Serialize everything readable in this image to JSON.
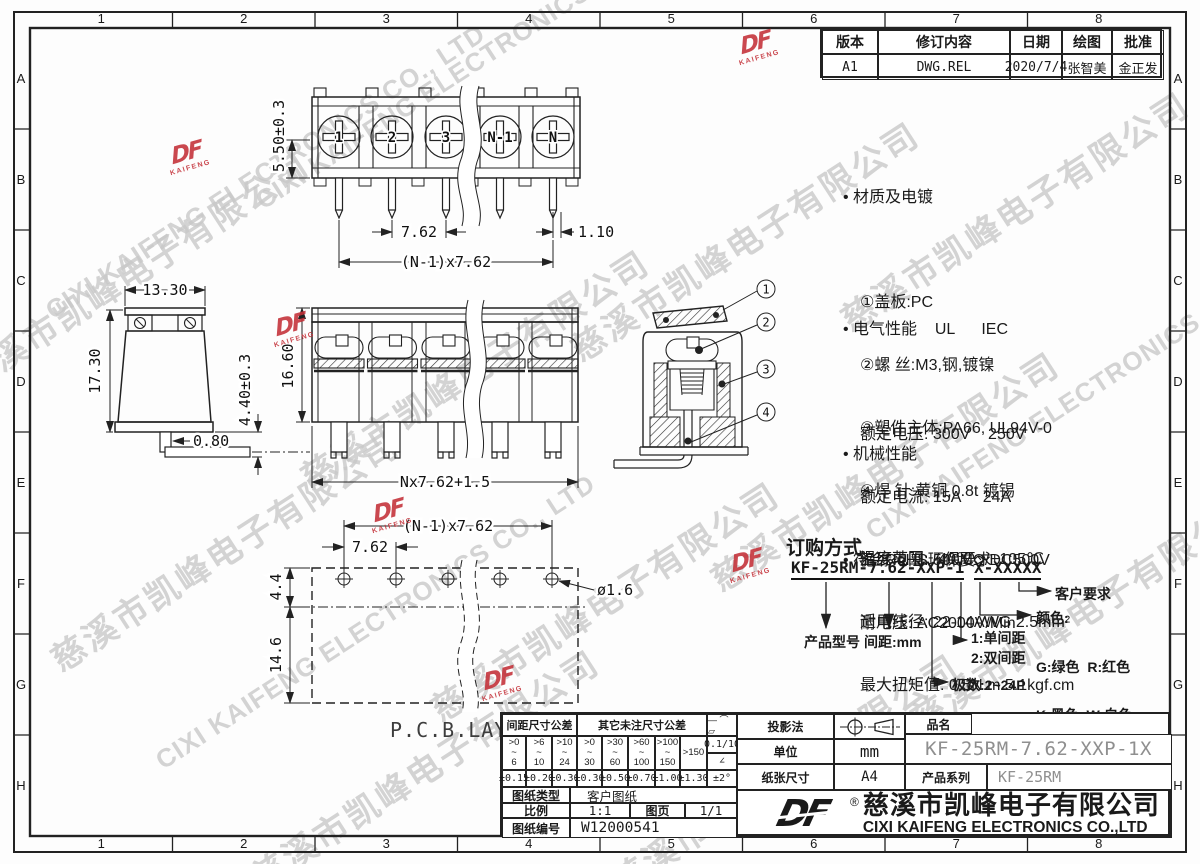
{
  "frame": {
    "cols": [
      "1",
      "2",
      "3",
      "4",
      "5",
      "6",
      "7",
      "8"
    ],
    "rows": [
      "A",
      "B",
      "C",
      "D",
      "E",
      "F",
      "G",
      "H"
    ]
  },
  "revision": {
    "headers": [
      "版本",
      "修订内容",
      "日期",
      "绘图",
      "批准"
    ],
    "row": [
      "A1",
      "DWG.REL",
      "2020/7/4",
      "张智美",
      "金正发"
    ]
  },
  "specs": {
    "material": {
      "title": "• 材质及电镀",
      "items": [
        "①盖板:PC",
        "②螺 丝:M3,钢,镀镍",
        "③塑件主体:PA66, UL94V-0",
        "④焊 针:黄铜,0.8t 镀锡"
      ]
    },
    "electrical": {
      "title": "• 电气性能    UL      IEC",
      "rows": [
        "额定电压: 300V    250V",
        "额定电流: 15A     24A",
        "绝缘电阻: 500MΩ/DC500V",
        "耐电压: AC2000V/Min"
      ]
    },
    "mechanical": {
      "title": "• 机械性能",
      "rows": [
        "温度范围: -40℃～+105℃",
        "适用线径: 22-14AWG 2.5mm²",
        "最大扭矩值: 0.5N.m 5.1kgf.cm"
      ]
    },
    "rohs": "• 符合RoHS环保要求"
  },
  "ordering": {
    "title": "订购方式",
    "code_left": "KF-25RM-7.62-XXP-1",
    "code_right": "X-XXXXX",
    "labels": {
      "model": "产品型号",
      "pitch": "间距:mm",
      "poles": "极数:2~24P",
      "single": "1:单间距",
      "double": "2:双间距",
      "color_title": "颜色:",
      "colors": [
        "G:绿色  R:红色",
        "K:黑色  W:白色",
        "O:橙色  B:蓝色",
        "GR:灰色"
      ],
      "customer": "客户要求"
    }
  },
  "dims": {
    "v1_height": "5.50±0.3",
    "v1_pitch": "7.62",
    "v1_edge": "1.10",
    "v1_total": "(N-1)x7.62",
    "screws": [
      "1",
      "2",
      "3",
      "N-1",
      "N"
    ],
    "v2_width": "13.30",
    "v2_height": "17.30",
    "v2_pin": "0.80",
    "v2_pinlen": "4.40±0.3",
    "v3_height": "16.60",
    "v3_total": "Nx7.62+1.5",
    "callouts": [
      "1",
      "2",
      "3",
      "4"
    ],
    "pcb_total": "(N-1)x7.62",
    "pcb_pitch": "7.62",
    "pcb_top": "4.4",
    "pcb_height": "14.6",
    "pcb_hole": "ø1.6",
    "pcb_label": "P.C.B.LAYOUT"
  },
  "title_block": {
    "tol_pitch_title": "间距尺寸公差",
    "tol_other_title": "其它未注尺寸公差",
    "symbols": "— ⌒ ▱",
    "flatness": "0.1/10",
    "angle_symbol": "∠",
    "angle_tol": "±2°",
    "ranges": [
      [
        ">0",
        "~",
        "6"
      ],
      [
        ">6",
        "~",
        "10"
      ],
      [
        ">10",
        "~",
        "24"
      ],
      [
        ">0",
        "~",
        "30"
      ],
      [
        ">30",
        "~",
        "60"
      ],
      [
        ">60",
        "~",
        "100"
      ],
      [
        ">100",
        "~",
        "150"
      ]
    ],
    "range_150": ">150",
    "tols": [
      "±0.15",
      "±0.20",
      "±0.30",
      "±0.30",
      "±0.50",
      "±0.70",
      "±1.00",
      "±1.30"
    ],
    "projection_label": "投影法",
    "unit_label": "单位",
    "unit_value": "mm",
    "paper_label": "纸张尺寸",
    "paper_value": "A4",
    "pn_label": "品名",
    "pn_value": "KF-25RM-7.62-XXP-1X",
    "series_label": "产品系列",
    "series_value": "KF-25RM",
    "type_label": "图纸类型",
    "type_value": "客户图纸",
    "scale_label": "比例",
    "scale_value": "1:1",
    "page_label": "图页",
    "page_value": "1/1",
    "no_label": "图纸编号",
    "no_value": "W12000541"
  },
  "company": {
    "logo": "DF",
    "reg": "®",
    "cn": "慈溪市凯峰电子有限公司",
    "en": "CIXI KAIFENG ELECTRONICS CO.,LTD"
  },
  "watermark": {
    "cn": "慈溪市凯峰电子有限公司",
    "en": "CIXI KAIFENG ELECTRONICS CO., LTD",
    "logo": "DF",
    "logo_sub": "KAIFENG"
  },
  "colors": {
    "line": "#222222",
    "stamp_red": "#c43038",
    "value_gray": "#8f8f8f",
    "watermark_gray": "#c9c9c9"
  }
}
